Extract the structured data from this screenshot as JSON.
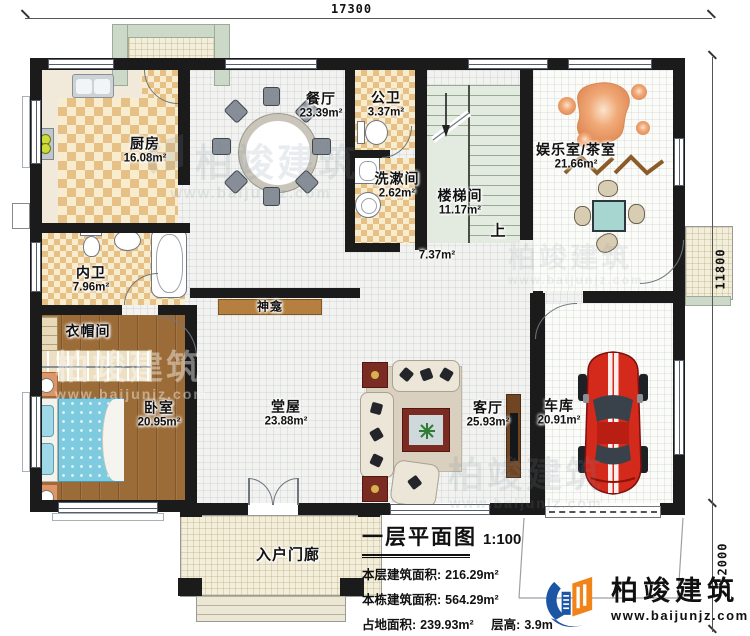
{
  "dimensions": {
    "top_width": "17300",
    "right_height": "11800",
    "porch_depth": "2000"
  },
  "rooms": {
    "kitchen": {
      "name": "厨房",
      "area": "16.08m²"
    },
    "dining": {
      "name": "餐厅",
      "area": "23.39m²"
    },
    "public_bath": {
      "name": "公卫",
      "area": "3.37m²"
    },
    "washroom": {
      "name": "洗漱间",
      "area": "2.62m²"
    },
    "stairwell": {
      "name": "楼梯间",
      "area": "11.17m²"
    },
    "entertainment": {
      "name": "娱乐室/茶室",
      "area": "21.66m²"
    },
    "private_bath": {
      "name": "内卫",
      "area": "7.96m²"
    },
    "cloakroom": {
      "name": "衣帽间"
    },
    "bedroom": {
      "name": "卧室",
      "area": "20.95m²"
    },
    "main_hall": {
      "name": "堂屋",
      "area": "23.88m²"
    },
    "living": {
      "name": "客厅",
      "area": "25.93m²"
    },
    "garage": {
      "name": "车库",
      "area": "20.91m²"
    },
    "entry_porch": {
      "name": "入户门廊"
    },
    "shrine": {
      "name": "神龛"
    }
  },
  "annotations": {
    "hall_open_area": "7.37m²",
    "stairs_direction": "上"
  },
  "title_block": {
    "title": "一层平面图",
    "scale": "1:100",
    "rows": [
      {
        "label": "本层建筑面积:",
        "value": "216.29m²"
      },
      {
        "label": "本栋建筑面积:",
        "value": "564.29m²"
      },
      {
        "label": "占地面积:",
        "value": "239.93m²",
        "label2": "层高:",
        "value2": "3.9m"
      }
    ]
  },
  "brand": {
    "name": "柏竣建筑",
    "url": "www.baijunjz.com"
  },
  "watermark": {
    "name": "柏竣建筑",
    "url": "www.baijunjz.com"
  },
  "colors": {
    "wall": "#1b1b1b",
    "logo_blue": "#1d55a6",
    "logo_orange": "#f08418",
    "car_red": "#d42a1c",
    "bed_teal": "#7ecade",
    "wood": "#9c6c38"
  }
}
